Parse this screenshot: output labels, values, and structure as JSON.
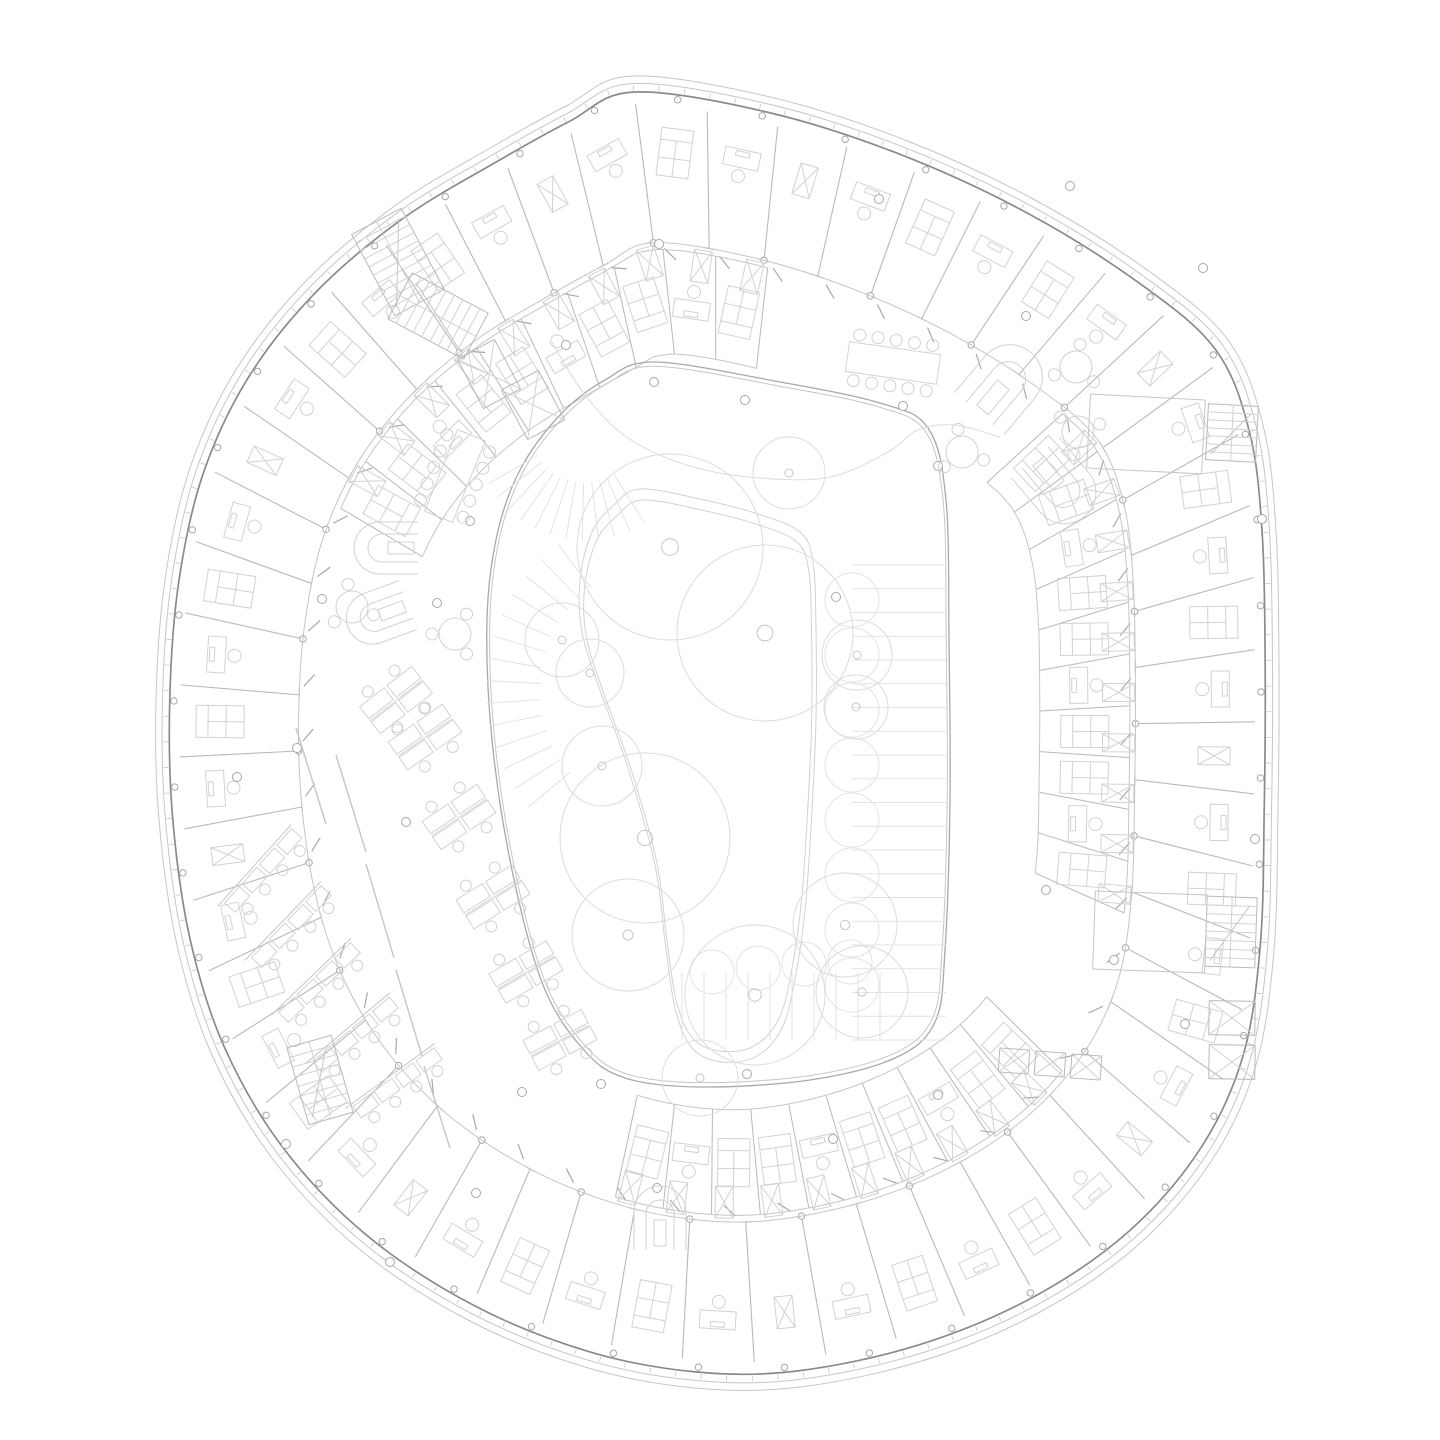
{
  "canvas": {
    "width": 1440,
    "height": 1440
  },
  "colors": {
    "background": "#ffffff",
    "line_faint": "#e3e3e3",
    "line_tree": "#dcdcdc",
    "line_furniture": "#d2d2d2",
    "line_light": "#c6c6c6",
    "line_partition": "#b9b9b9",
    "line_mid": "#a8a8a8",
    "line_dark": "#8a8a8a"
  },
  "building": {
    "centroid": [
      716,
      730
    ],
    "outline": [
      [
        632,
        76
      ],
      [
        770,
        97
      ],
      [
        905,
        140
      ],
      [
        1035,
        200
      ],
      [
        1150,
        272
      ],
      [
        1228,
        340
      ],
      [
        1263,
        425
      ],
      [
        1276,
        530
      ],
      [
        1279,
        670
      ],
      [
        1278,
        810
      ],
      [
        1274,
        950
      ],
      [
        1256,
        1065
      ],
      [
        1212,
        1160
      ],
      [
        1138,
        1245
      ],
      [
        1040,
        1312
      ],
      [
        925,
        1360
      ],
      [
        800,
        1387
      ],
      [
        695,
        1388
      ],
      [
        585,
        1367
      ],
      [
        468,
        1320
      ],
      [
        358,
        1248
      ],
      [
        272,
        1158
      ],
      [
        212,
        1055
      ],
      [
        177,
        945
      ],
      [
        159,
        820
      ],
      [
        156,
        700
      ],
      [
        165,
        580
      ],
      [
        190,
        468
      ],
      [
        237,
        368
      ],
      [
        307,
        280
      ],
      [
        396,
        205
      ],
      [
        492,
        147
      ],
      [
        566,
        106
      ]
    ],
    "shells": [
      {
        "scale": 1.0,
        "stroke": "line_light",
        "width": 1
      },
      {
        "scale": 0.9885,
        "stroke": "line_light",
        "width": 1
      },
      {
        "scale": 0.9755,
        "stroke": "line_dark",
        "width": 1.7
      }
    ],
    "mullions": {
      "count": 150,
      "scale": 0.982,
      "len": 5
    },
    "facade_columns": {
      "count": 44,
      "scale": 0.968,
      "r": 3.2
    },
    "partitions": {
      "count": 52,
      "outer": 0.957,
      "inner": 0.745,
      "cap": 6
    },
    "inner_ring_scale": 0.745,
    "door_ticks": {
      "offset": 0.28,
      "scale": 0.728,
      "len": 16,
      "skew": 40
    },
    "furniture_scale": 0.885,
    "furniture_cycle": [
      "bed",
      "desk",
      "wardrobe",
      "desk",
      "bed",
      "desk"
    ]
  },
  "second_band": {
    "outer": 0.735,
    "inner": 0.575,
    "furn": 0.655,
    "wardrobe_at": 0.715,
    "segments": [
      {
        "from": 0.155,
        "to": 0.335,
        "cells": 10
      },
      {
        "from": 0.395,
        "to": 0.565,
        "cells": 10
      },
      {
        "from": 0.855,
        "to": 1.04,
        "cells": 10
      }
    ]
  },
  "courtyard": {
    "centroid": [
      718,
      722
    ],
    "outline": [
      [
        655,
        362
      ],
      [
        780,
        382
      ],
      [
        880,
        403
      ],
      [
        928,
        428
      ],
      [
        946,
        500
      ],
      [
        949,
        640
      ],
      [
        950,
        800
      ],
      [
        945,
        950
      ],
      [
        935,
        1022
      ],
      [
        895,
        1058
      ],
      [
        810,
        1080
      ],
      [
        700,
        1087
      ],
      [
        625,
        1078
      ],
      [
        583,
        1049
      ],
      [
        543,
        985
      ],
      [
        512,
        870
      ],
      [
        492,
        740
      ],
      [
        487,
        620
      ],
      [
        497,
        535
      ],
      [
        520,
        470
      ],
      [
        560,
        415
      ],
      [
        605,
        380
      ]
    ],
    "edges": [
      {
        "scale": 1.0,
        "stroke": "line_mid",
        "width": 1.3
      },
      {
        "scale": 0.988,
        "stroke": "line_light",
        "width": 1
      }
    ]
  },
  "walkway": {
    "pts": [
      [
        640,
        489
      ],
      [
        700,
        499
      ],
      [
        758,
        514
      ],
      [
        800,
        532
      ],
      [
        813,
        562
      ],
      [
        816,
        630
      ],
      [
        816,
        720
      ],
      [
        812,
        810
      ],
      [
        806,
        900
      ],
      [
        797,
        968
      ],
      [
        783,
        1026
      ],
      [
        757,
        1056
      ],
      [
        722,
        1062
      ],
      [
        693,
        1049
      ],
      [
        676,
        1012
      ],
      [
        666,
        950
      ],
      [
        655,
        865
      ],
      [
        628,
        768
      ],
      [
        600,
        690
      ],
      [
        582,
        632
      ],
      [
        580,
        580
      ],
      [
        592,
        532
      ],
      [
        614,
        505
      ]
    ],
    "scales": [
      1.0,
      0.962
    ]
  },
  "hill_contour": [
    [
      552,
      342
    ],
    [
      585,
      395
    ],
    [
      628,
      438
    ],
    [
      690,
      466
    ],
    [
      760,
      478
    ],
    [
      830,
      477
    ],
    [
      888,
      452
    ],
    [
      918,
      430
    ],
    [
      955,
      425
    ],
    [
      1000,
      437
    ]
  ],
  "deck": {
    "fans": [
      {
        "cx": 585,
        "cy": 428,
        "r1": 55,
        "r2": 112,
        "a0": 58,
        "a1": 150,
        "n": 11
      },
      {
        "cx": 668,
        "cy": 690,
        "r1": 128,
        "r2": 182,
        "a0": 140,
        "a1": 233,
        "n": 13
      }
    ],
    "rows": {
      "x1": 852,
      "x2": 946,
      "y0": 565,
      "y1": 1040,
      "n": 20
    },
    "cols": {
      "y0": 972,
      "y1": 1040,
      "x0": 682,
      "x1": 880,
      "n": 9
    },
    "scallops": [
      [
        852,
        600,
        27
      ],
      [
        852,
        655,
        27
      ],
      [
        852,
        710,
        27
      ],
      [
        852,
        765,
        27
      ],
      [
        852,
        820,
        27
      ],
      [
        852,
        875,
        27
      ],
      [
        852,
        930,
        27
      ],
      [
        852,
        985,
        27
      ],
      [
        712,
        972,
        22
      ],
      [
        758,
        968,
        22
      ],
      [
        804,
        964,
        22
      ],
      [
        850,
        962,
        22
      ]
    ]
  },
  "trees": {
    "big": [
      [
        670,
        547,
        93
      ],
      [
        765,
        633,
        88
      ],
      [
        645,
        838,
        85
      ],
      [
        755,
        995,
        70
      ],
      [
        628,
        935,
        56
      ],
      [
        845,
        925,
        52
      ],
      [
        862,
        992,
        46
      ],
      [
        789,
        473,
        36
      ],
      [
        857,
        655,
        35
      ],
      [
        590,
        673,
        34
      ],
      [
        856,
        707,
        32
      ],
      [
        602,
        766,
        40
      ],
      [
        562,
        640,
        37
      ],
      [
        700,
        1078,
        38
      ]
    ]
  },
  "scatter_dots": [
    [
      437,
      603
    ],
    [
      470,
      521
    ],
    [
      566,
      345
    ],
    [
      654,
      382
    ],
    [
      745,
      400
    ],
    [
      903,
      406
    ],
    [
      938,
      466
    ],
    [
      1070,
      186
    ],
    [
      1026,
      316
    ],
    [
      322,
      599
    ],
    [
      237,
      777
    ],
    [
      297,
      748
    ],
    [
      406,
      822
    ],
    [
      522,
      1092
    ],
    [
      601,
      1084
    ],
    [
      657,
      1188
    ],
    [
      938,
      1095
    ],
    [
      833,
      1139
    ],
    [
      1046,
      890
    ],
    [
      1114,
      960
    ],
    [
      1185,
      1024
    ],
    [
      286,
      1144
    ],
    [
      476,
      1193
    ],
    [
      747,
      1074
    ],
    [
      1255,
      839
    ],
    [
      1262,
      519
    ],
    [
      659,
      244
    ],
    [
      879,
      199
    ],
    [
      1203,
      268
    ],
    [
      390,
      1262
    ],
    [
      836,
      597
    ]
  ],
  "u_sofas": [
    [
      1005,
      383,
      220,
      1.25
    ],
    [
      1060,
      487,
      -40,
      1.2
    ],
    [
      386,
      548,
      90,
      1.0
    ],
    [
      378,
      616,
      70,
      1.0
    ],
    [
      660,
      1218,
      180,
      1.0
    ]
  ],
  "round_tables": [
    [
      352,
      607,
      0
    ],
    [
      455,
      634,
      40
    ],
    [
      962,
      452,
      0
    ],
    [
      1076,
      367,
      20
    ],
    [
      1078,
      432,
      200
    ]
  ],
  "meeting_tables": [
    {
      "x": 455,
      "y": 476,
      "w": 30,
      "h": 88,
      "rot": 22,
      "chairs": 10
    },
    {
      "x": 893,
      "y": 363,
      "w": 92,
      "h": 30,
      "rot": 8,
      "chairs": 10
    }
  ],
  "desk_clusters": [
    [
      425,
      737,
      -35
    ],
    [
      459,
      817,
      -34
    ],
    [
      493,
      897,
      -32
    ],
    [
      526,
      972,
      -30
    ],
    [
      396,
      700,
      -38
    ],
    [
      560,
      1040,
      -28
    ]
  ],
  "bench_rows": [
    [
      262,
      872,
      -48
    ],
    [
      290,
      928,
      -46
    ],
    [
      318,
      984,
      -44
    ],
    [
      354,
      1036,
      -40
    ],
    [
      396,
      1084,
      -36
    ]
  ],
  "screens": [
    [
      336,
      755,
      366,
      852
    ],
    [
      366,
      864,
      394,
      958
    ],
    [
      396,
      970,
      422,
      1056
    ],
    [
      296,
      728,
      326,
      824
    ],
    [
      424,
      1066,
      450,
      1148
    ]
  ],
  "stairs": [
    {
      "x": 398,
      "y": 262,
      "w": 56,
      "h": 92,
      "rot": -28,
      "steps": 10
    },
    {
      "x": 438,
      "y": 316,
      "w": 52,
      "h": 86,
      "rot": -62,
      "steps": 9
    },
    {
      "x": 1232,
      "y": 433,
      "w": 50,
      "h": 56,
      "rot": 3,
      "steps": 7
    },
    {
      "x": 1231,
      "y": 932,
      "w": 50,
      "h": 70,
      "rot": 2,
      "steps": 8
    },
    {
      "x": 320,
      "y": 1080,
      "w": 46,
      "h": 80,
      "rot": -16,
      "steps": 8
    }
  ],
  "stair_rooms": [
    [
      1146,
      434,
      115,
      74,
      3
    ],
    [
      1150,
      932,
      112,
      78,
      2
    ]
  ],
  "lifts": [
    [
      489,
      374,
      42,
      56,
      -28
    ],
    [
      533,
      405,
      42,
      56,
      -28
    ],
    [
      1014,
      1061,
      30,
      24,
      4
    ],
    [
      1050,
      1064,
      30,
      24,
      4
    ],
    [
      1086,
      1067,
      30,
      24,
      4
    ],
    [
      1232,
      1018,
      46,
      34,
      1
    ],
    [
      1232,
      1062,
      46,
      34,
      1
    ]
  ]
}
